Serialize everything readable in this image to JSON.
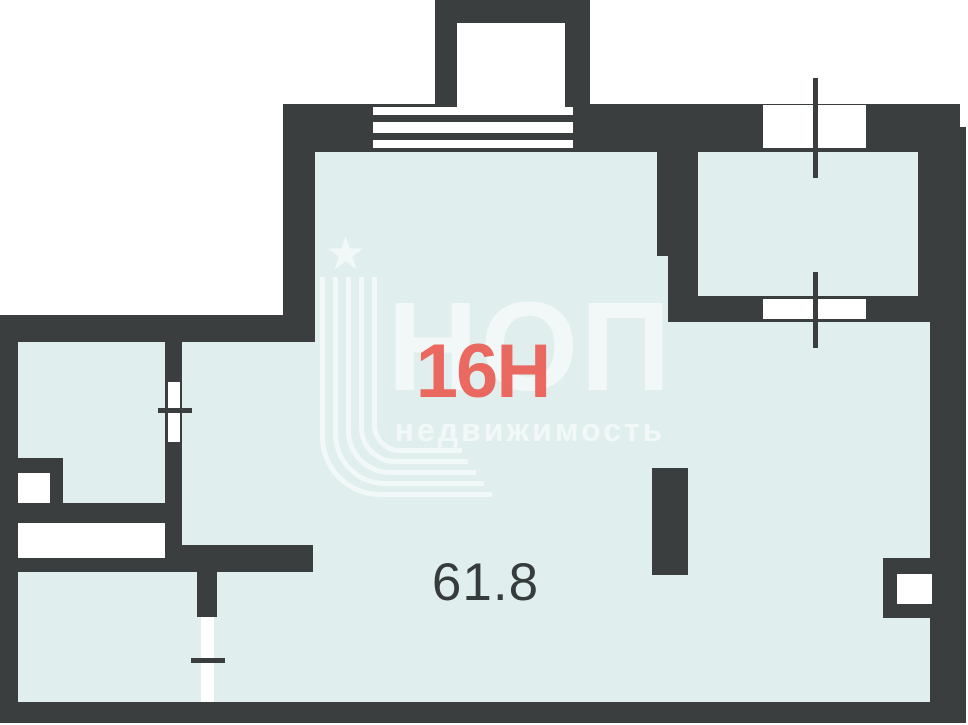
{
  "plan": {
    "unit_label": "16Н",
    "area_value": "61.8"
  },
  "watermark": {
    "brand": "НОП",
    "tagline": "недвижимость",
    "star_glyph": "★"
  },
  "colors": {
    "wall": "#3a3e3e",
    "floor": "#e0efed",
    "accent_red": "#eb5a51",
    "area_text": "#363b3b",
    "watermark": "rgba(255,255,255,0.55)",
    "background": "#ffffff"
  }
}
